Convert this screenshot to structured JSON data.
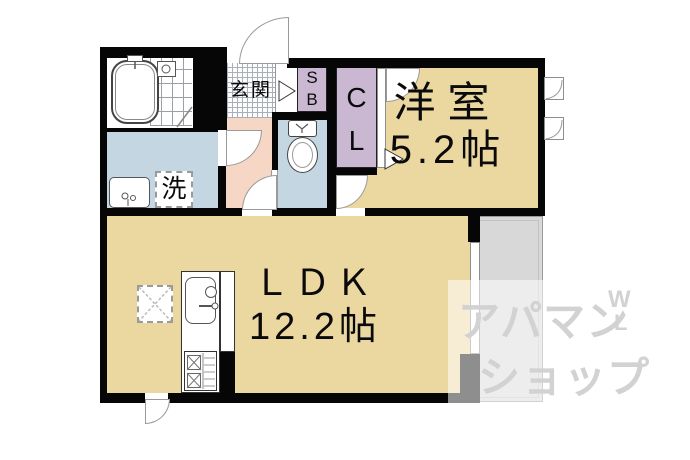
{
  "plan_type": "floor-plan",
  "rooms": {
    "genkan": {
      "label": "玄関"
    },
    "shoe_box": {
      "line1": "S",
      "line2": "B"
    },
    "closet": {
      "line1": "C",
      "line2": "L"
    },
    "western_room": {
      "name": "洋室",
      "size": "5.2帖"
    },
    "ldk": {
      "name": "ＬＤＫ",
      "size": "12.2帖"
    },
    "laundry": {
      "label": "洗"
    }
  },
  "watermark": {
    "row1": "アパマン",
    "row2": "ショップ",
    "mark_top": "W",
    "mark_bottom": "L"
  },
  "colors": {
    "wall": "#060606",
    "room_beige": "#ebd7a0",
    "wet_area_blue": "#c3d6e2",
    "hall_pink": "#f6d6c5",
    "storage_lavender": "#cab8d3",
    "balcony_grey": "#d8d8d8",
    "watermark_grey": "#d2d2d2"
  }
}
